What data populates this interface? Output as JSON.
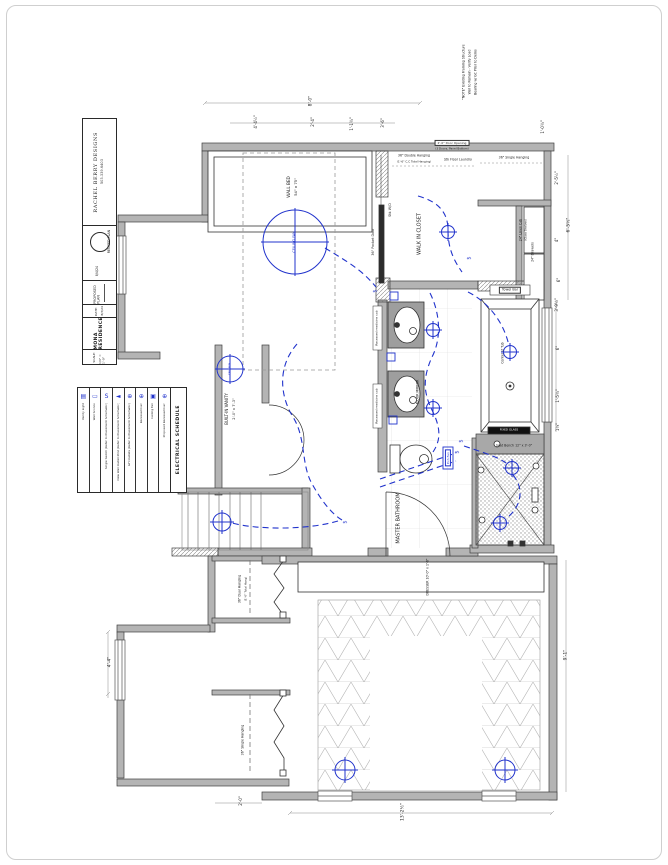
{
  "page": {
    "background": "#ffffff",
    "border_color": "#cfcfcf"
  },
  "colors": {
    "electric_blue": "#2133cc",
    "wall_gray": "#b4b4b4",
    "ink": "#1d1d1d"
  },
  "title_block": {
    "firm_name": "RACHEL BERRY DESIGNS",
    "firm_phone": "503.339.6403",
    "stamp_label": "REVISED PLAN",
    "stamp_date": "8/4/24",
    "plan_type": "PROPOSED PLAN",
    "date_label": "DATE:",
    "date_value": "8/3/24",
    "project_name": "MONA RESIDENCE",
    "scale_label": "SCALE:",
    "scale_value": "1/4\" = 1'-0\""
  },
  "legend": {
    "title": "ELECTRICAL SCHEDULE",
    "items": [
      {
        "icon": "recessed-can-proposed",
        "glyph": "⊕",
        "label": "Proposed Recessed Can"
      },
      {
        "icon": "ceiling-fan",
        "glyph": "▣",
        "label": "Ceiling Fan"
      },
      {
        "icon": "recessed-can",
        "glyph": "⊕",
        "label": "Recessed Can"
      },
      {
        "icon": "gfi-outlet",
        "glyph": "⊕",
        "label": "GFI Outlets (Refer to Placement Schematic)"
      },
      {
        "icon": "wall-outlet",
        "glyph": "◄",
        "label": "New Wall Outlet Plmt (Refer to Placement Schematic)"
      },
      {
        "icon": "single-switch",
        "glyph": "S",
        "label": "Single Switch (Refer to Placement Schematic)"
      },
      {
        "icon": "wall-sconce",
        "glyph": "▭",
        "label": "Wall Sconce"
      },
      {
        "icon": "vanity-light",
        "glyph": "▤",
        "label": "Vanity Light"
      }
    ]
  },
  "labels": [
    {
      "n": "note-label",
      "t": "\"NOTE\" Existing Framing Structure",
      "x": 464,
      "y": 72,
      "r": -90,
      "s": 3.2
    },
    {
      "n": "note-label",
      "t": "Wall to Remain - Verify Load",
      "x": 470,
      "y": 72,
      "r": -90,
      "s": 3.2
    },
    {
      "n": "note-label",
      "t": "Bearing w/ GC Prior to Demo",
      "x": 476,
      "y": 72,
      "r": -90,
      "s": 3.2
    },
    {
      "n": "dimension-label",
      "t": "8'-0\"",
      "x": 312,
      "y": 101,
      "r": -90,
      "s": 4.5
    },
    {
      "n": "dimension-label",
      "t": "4'-4½\"",
      "x": 256,
      "y": 122,
      "r": -90,
      "s": 4
    },
    {
      "n": "dimension-label",
      "t": "2'-4\"",
      "x": 313,
      "y": 122,
      "r": -90,
      "s": 4
    },
    {
      "n": "dimension-label",
      "t": "1'-1¾\"",
      "x": 352,
      "y": 124,
      "r": -90,
      "s": 4
    },
    {
      "n": "dimension-label",
      "t": "3'-6\"",
      "x": 383,
      "y": 123,
      "r": -90,
      "s": 4
    },
    {
      "n": "dimension-label",
      "t": "1'-0¾\"",
      "x": 543,
      "y": 127,
      "r": -90,
      "s": 4
    },
    {
      "n": "dimension-label",
      "t": "2'-5½\"",
      "x": 557,
      "y": 178,
      "r": -90,
      "s": 4
    },
    {
      "n": "dimension-label",
      "t": "6'-5½\"",
      "x": 570,
      "y": 225,
      "r": -90,
      "s": 4.5
    },
    {
      "n": "dimension-label",
      "t": "4\"",
      "x": 557,
      "y": 240,
      "r": -90,
      "s": 4
    },
    {
      "n": "dimension-label",
      "t": "6\"",
      "x": 559,
      "y": 280,
      "r": -90,
      "s": 4
    },
    {
      "n": "dimension-label",
      "t": "3'-9½\"",
      "x": 557,
      "y": 305,
      "r": -90,
      "s": 4
    },
    {
      "n": "dimension-label",
      "t": "6\"",
      "x": 558,
      "y": 348,
      "r": -90,
      "s": 4
    },
    {
      "n": "dimension-label",
      "t": "1'-5¾\"",
      "x": 558,
      "y": 396,
      "r": -90,
      "s": 4
    },
    {
      "n": "dimension-label",
      "t": "1¼\"",
      "x": 558,
      "y": 427,
      "r": -90,
      "s": 4
    },
    {
      "n": "dimension-label",
      "t": "9'-1\"",
      "x": 567,
      "y": 655,
      "r": -90,
      "s": 4.5
    },
    {
      "n": "dimension-label",
      "t": "13'-2½\"",
      "x": 404,
      "y": 812,
      "r": -90,
      "s": 4.5
    },
    {
      "n": "dimension-label",
      "t": "2'-0\"",
      "x": 241,
      "y": 801,
      "r": -90,
      "s": 4
    },
    {
      "n": "dimension-label",
      "t": "4'-4\"",
      "x": 111,
      "y": 662,
      "r": -90,
      "s": 4.5
    },
    {
      "n": "fixture-label",
      "t": "WALL BED",
      "x": 289,
      "y": 187,
      "r": -90,
      "s": 4.2
    },
    {
      "n": "fixture-label",
      "t": "54\" x 75\"",
      "x": 296,
      "y": 187,
      "r": -90,
      "s": 3.8
    },
    {
      "n": "fixture-label",
      "t": "CEILING FAN",
      "x": 295,
      "y": 242,
      "r": -90,
      "s": 3.4,
      "c": "blue"
    },
    {
      "n": "room-label",
      "t": "WALK IN CLOSET",
      "x": 420,
      "y": 234,
      "r": -90,
      "s": 5
    },
    {
      "n": "fixture-label",
      "t": "36\" Pocket Door",
      "x": 374,
      "y": 242,
      "r": -90,
      "s": 3.4
    },
    {
      "n": "fixture-label",
      "t": "Stk W/D",
      "x": 391,
      "y": 210,
      "r": -90,
      "s": 3.4
    },
    {
      "n": "fixture-label",
      "t": "36\" Double Hanging",
      "x": 414,
      "y": 156,
      "r": 0,
      "s": 3.2
    },
    {
      "n": "fixture-label",
      "t": "(1'-6\" C.C Total Hanging)",
      "x": 414,
      "y": 162,
      "r": 0,
      "s": 2.8
    },
    {
      "n": "fixture-label",
      "t": "2'-0\" Door Opening",
      "x": 452,
      "y": 143,
      "r": 0,
      "s": 3,
      "b": "ink"
    },
    {
      "n": "fixture-label",
      "t": "(3 Doors, Panel Bottom)",
      "x": 452,
      "y": 149,
      "r": 0,
      "s": 2.8
    },
    {
      "n": "fixture-label",
      "t": "Stk Floor Laundry",
      "x": 458,
      "y": 160,
      "r": 0,
      "s": 3.2
    },
    {
      "n": "fixture-label",
      "t": "36\" Single Hanging",
      "x": 514,
      "y": 158,
      "r": 0,
      "s": 3.2
    },
    {
      "n": "fixture-label",
      "t": "24\" Linen Cab",
      "x": 521,
      "y": 230,
      "r": -90,
      "s": 3.2
    },
    {
      "n": "fixture-label",
      "t": "(Glass Shelves)",
      "x": 526,
      "y": 230,
      "r": -90,
      "s": 2.8
    },
    {
      "n": "fixture-label",
      "t": "24\" Drawers",
      "x": 533,
      "y": 252,
      "r": -90,
      "s": 3.2
    },
    {
      "n": "fixture-label",
      "t": "Towel Bar",
      "x": 510,
      "y": 290,
      "r": 0,
      "s": 3.4,
      "b": "ink"
    },
    {
      "n": "fixture-label",
      "t": "Center of Tub",
      "x": 503,
      "y": 353,
      "r": -90,
      "s": 3.2
    },
    {
      "n": "fixture-label",
      "t": "Recessed medicine cab",
      "x": 377,
      "y": 328,
      "r": -90,
      "s": 3
    },
    {
      "n": "fixture-label",
      "t": "Recessed medicine cab",
      "x": 377,
      "y": 406,
      "r": -90,
      "s": 3
    },
    {
      "n": "fixture-label",
      "t": "FLOOR MIRROR",
      "x": 418,
      "y": 392,
      "r": -90,
      "s": 3.2
    },
    {
      "n": "room-label",
      "t": "MASTER BATHROOM",
      "x": 399,
      "y": 518,
      "r": -90,
      "s": 5
    },
    {
      "n": "fixture-label",
      "t": "Exh Fan",
      "x": 448,
      "y": 458,
      "r": -90,
      "s": 3,
      "c": "blue",
      "b": "blue"
    },
    {
      "n": "fixture-label",
      "t": "Seat Bench 12\" x 3'-0\"",
      "x": 514,
      "y": 446,
      "r": 0,
      "s": 3.2
    },
    {
      "n": "fixture-label",
      "t": "FIXED GLASS",
      "x": 509,
      "y": 430,
      "r": 0,
      "s": 2.8,
      "c": "white"
    },
    {
      "n": "fixture-label",
      "t": "BUILT-IN VANITY",
      "x": 227,
      "y": 409,
      "r": -90,
      "s": 4
    },
    {
      "n": "fixture-label",
      "t": "2'-0\" x 7'-3\"",
      "x": 235,
      "y": 409,
      "r": -90,
      "s": 3.6
    },
    {
      "n": "fixture-label",
      "t": "CEIL FAN",
      "x": 230,
      "y": 369,
      "r": -90,
      "s": 2.8,
      "c": "blue"
    },
    {
      "n": "fixture-label",
      "t": "DRESSER 10'-0\" x 1'-6\"",
      "x": 428,
      "y": 577,
      "r": -90,
      "s": 3.2
    },
    {
      "n": "fixture-label",
      "t": "36\" Dual Hanging",
      "x": 240,
      "y": 589,
      "r": -90,
      "s": 3.2
    },
    {
      "n": "fixture-label",
      "t": "(1'-6\" Total Hang)",
      "x": 246,
      "y": 589,
      "r": -90,
      "s": 2.8
    },
    {
      "n": "fixture-label",
      "t": "36\" Single Hanging",
      "x": 243,
      "y": 740,
      "r": -90,
      "s": 3.2
    },
    {
      "n": "switch-symbol",
      "t": "$",
      "x": 376,
      "y": 291,
      "r": -90,
      "s": 5,
      "c": "blue"
    },
    {
      "n": "switch-symbol",
      "t": "$",
      "x": 458,
      "y": 452,
      "r": -90,
      "s": 5,
      "c": "blue"
    },
    {
      "n": "switch-symbol",
      "t": "$",
      "x": 346,
      "y": 522,
      "r": -90,
      "s": 5,
      "c": "blue"
    },
    {
      "n": "switch-symbol",
      "t": "$",
      "x": 470,
      "y": 258,
      "r": -90,
      "s": 5,
      "c": "blue"
    },
    {
      "n": "switch-symbol",
      "t": "$",
      "x": 462,
      "y": 441,
      "r": -90,
      "s": 5,
      "c": "blue"
    }
  ]
}
